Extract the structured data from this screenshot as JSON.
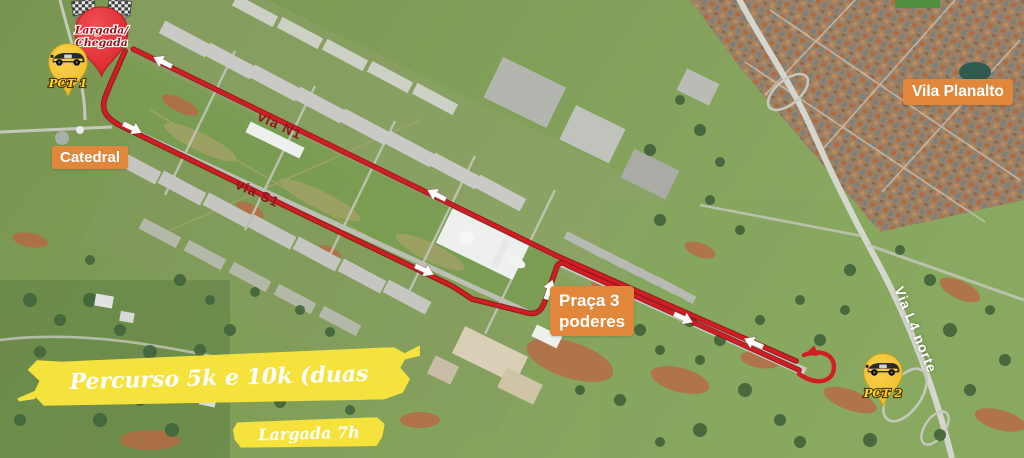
{
  "banners": {
    "course": "Percurso 5k e 10k (duas voltas)",
    "start_time": "Largada 7h"
  },
  "pins": {
    "start_finish": {
      "line1": "Largada/",
      "line2": "Chegada",
      "icon": "checkered-flags-icon"
    },
    "pct1": {
      "label": "PCT 1",
      "icon": "race-car-icon"
    },
    "pct2": {
      "label": "PCT 2",
      "icon": "race-car-icon"
    }
  },
  "place_labels": {
    "catedral": "Catedral",
    "vila_planalto": "Vila Planalto",
    "praca_line1": "Praça 3",
    "praca_line2": "poderes"
  },
  "road_labels": {
    "via_n1": "via N1",
    "via_s1": "via S1",
    "via_l4": "Via L4 norte"
  },
  "colors": {
    "route_red": "#d31d24",
    "label_orange": "#e0873c",
    "banner_yellow": "#f6e23c",
    "pin_red": "#e8393d",
    "pin_yellow": "#f3c42c"
  }
}
